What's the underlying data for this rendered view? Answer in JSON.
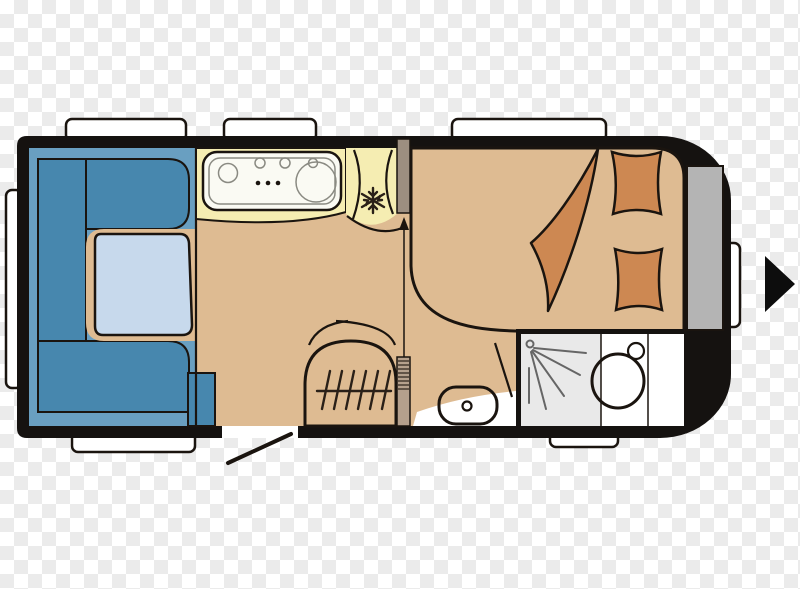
{
  "diagram": {
    "kind": "caravan-floor-plan",
    "features": [
      "u-shaped dinette with table",
      "kitchen block with hob, three knobs and round sink",
      "refrigerator with snowflake symbol",
      "double bed with two pillows and folded duvet",
      "shower cubicle with spray symbol",
      "toilet and cistern",
      "washbasin",
      "heater with grille and door arcs",
      "entry door with swing line",
      "seven windows",
      "front storage panel",
      "right direction arrow"
    ]
  },
  "colors": {
    "body": "#151210",
    "outline": "#1a140f",
    "floor": "#debb92",
    "seat_light": "#699fc1",
    "seat_dark": "#4787ae",
    "table": "#c7d9ec",
    "counter": "#f5edb2",
    "appliance_white": "#fafaf3",
    "bed": "#ee9b60",
    "bedding": "#cd8852",
    "wall": "#9c8e80",
    "heater": "#a9917e",
    "hinge": "#b5a08c",
    "shower": "#e9e9e9",
    "panel": "#b4b4b4",
    "white": "#ffffff",
    "arrow": "#0d0d0d",
    "checker": "#ebebeb"
  }
}
